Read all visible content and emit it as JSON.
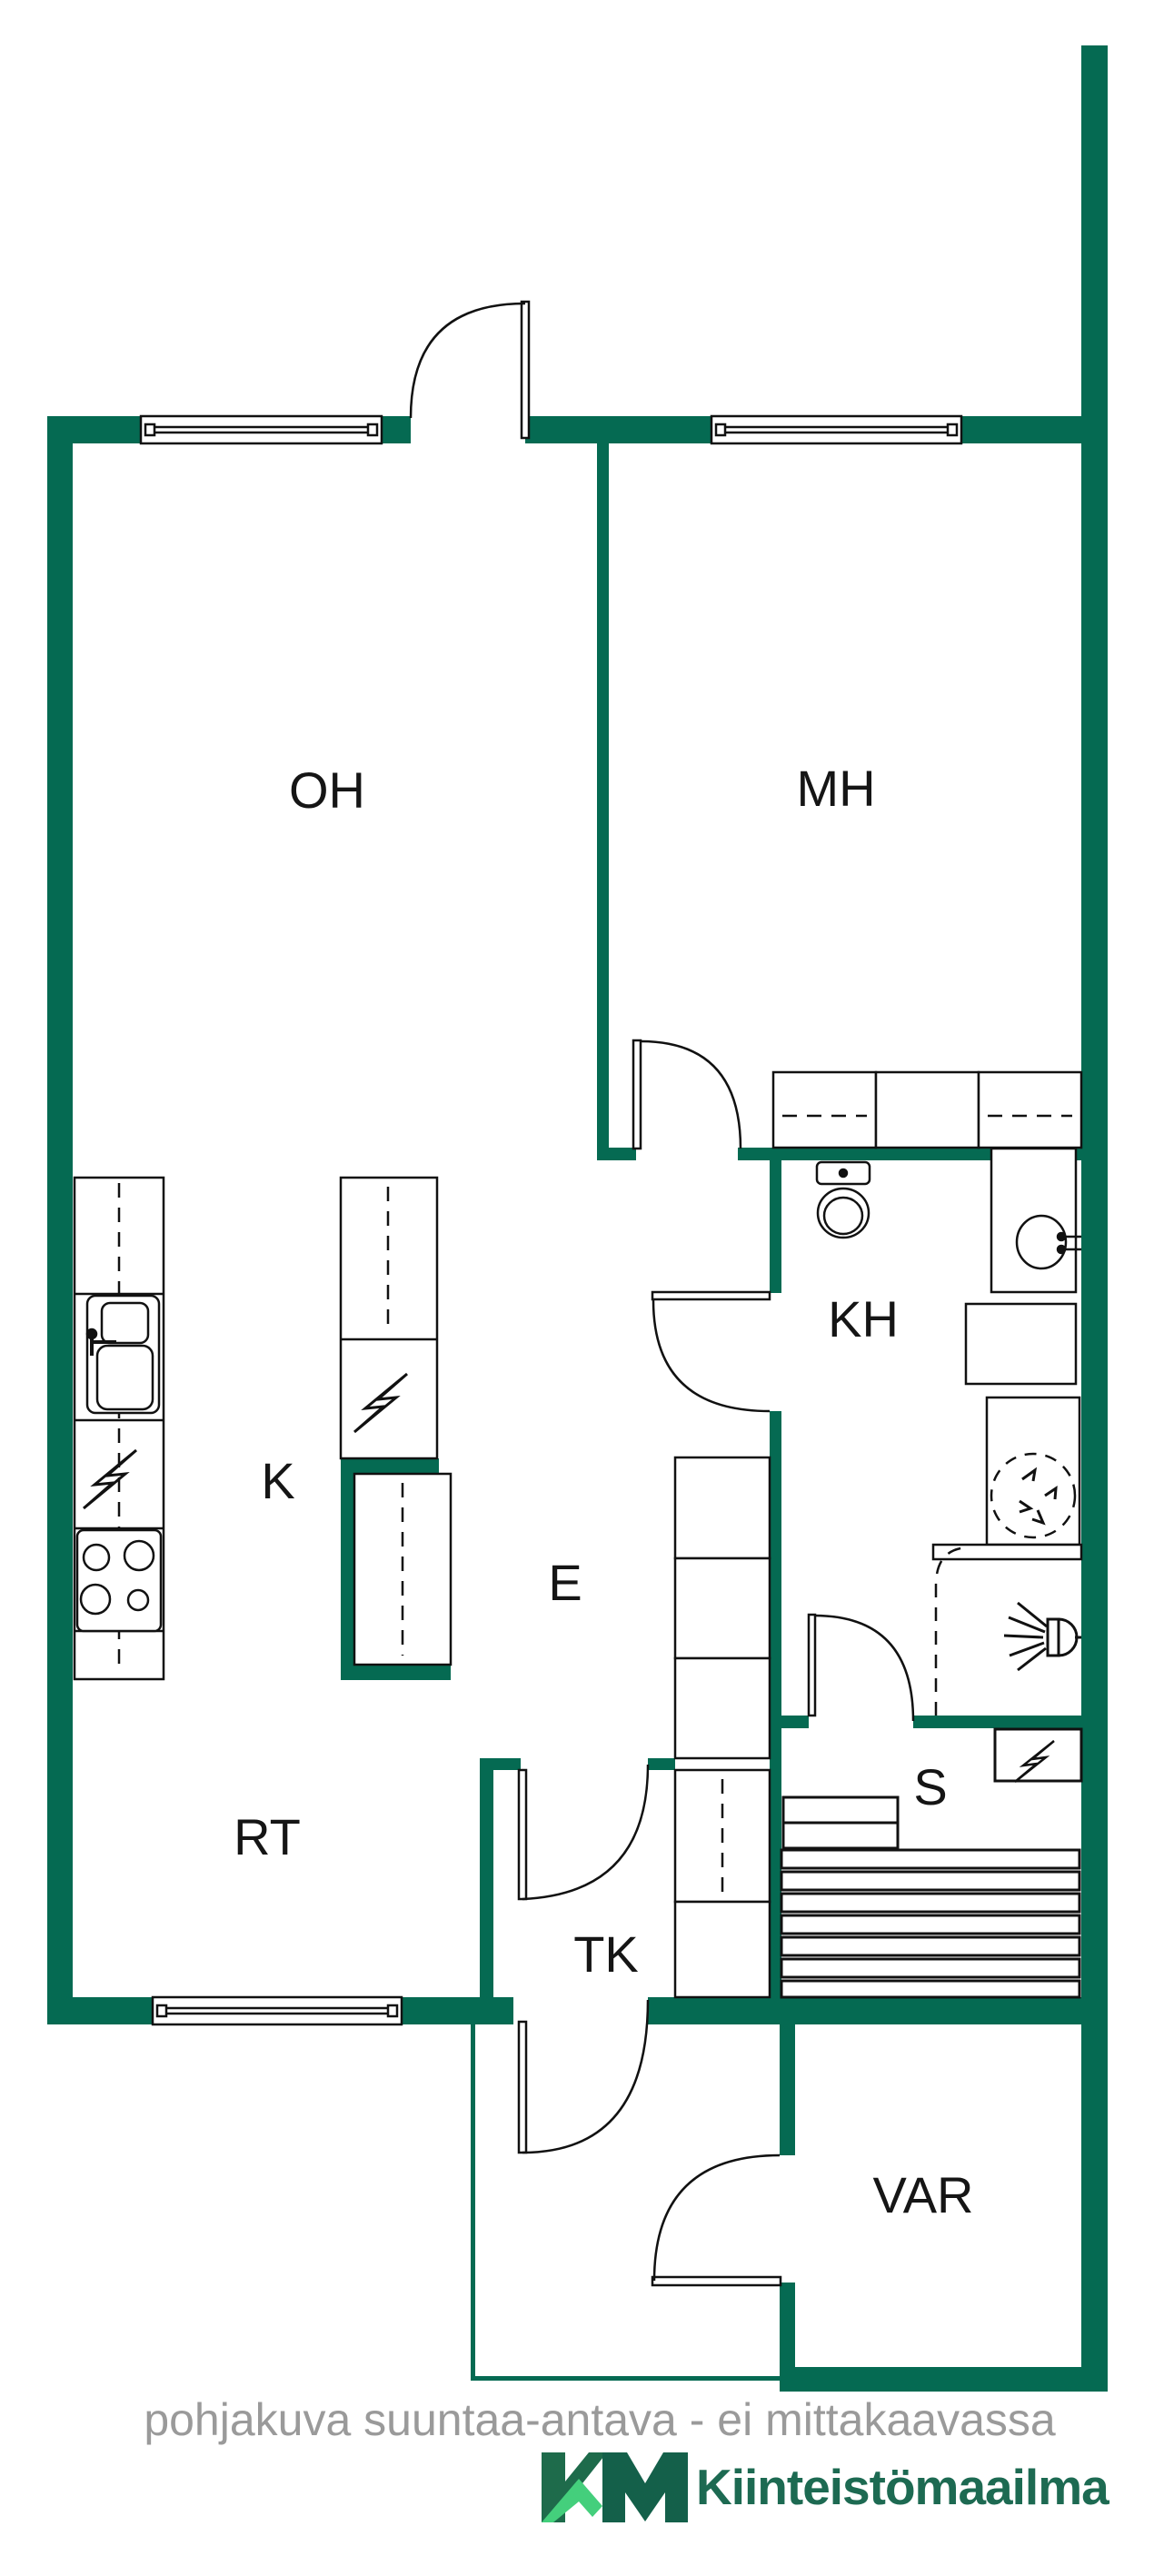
{
  "rooms": {
    "oh": "OH",
    "mh": "MH",
    "k": "K",
    "kh": "KH",
    "e": "E",
    "rt": "RT",
    "s": "S",
    "tk": "TK",
    "var": "VAR"
  },
  "footer": {
    "disclaimer": "pohjakuva suuntaa-antava - ei mittakaavassa",
    "logo_text": "Kiinteistömaailma"
  },
  "icons": {
    "lightning": "electric-appliance-symbol",
    "shower": "shower-head-symbol",
    "washing_machine": "washing-machine-reservation-symbol"
  },
  "colors": {
    "wall": "#056a52",
    "line": "#111111",
    "label": "#151515",
    "muted_text": "#9a9a9a",
    "logo_dark": "#1d6a52",
    "logo_k": "#1e6b4b",
    "logo_m": "#14604a",
    "logo_light": "#44cf7c"
  }
}
